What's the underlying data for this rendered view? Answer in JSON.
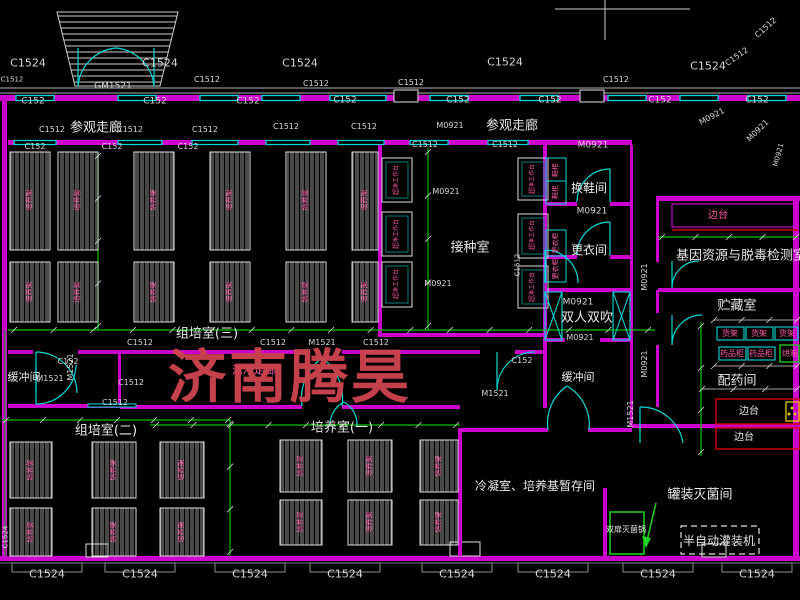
{
  "drawing": {
    "watermark": {
      "text": "济南腾昊",
      "color": "#cf4450"
    },
    "colors": {
      "background": "#000000",
      "wall_magenta": "#cc00cc",
      "window_cyan": "#00d9d9",
      "dimension_green": "#00c000",
      "text_white": "#e4e4e4",
      "equipment_pink": "#fa5aa5",
      "bench_red": "#d90000",
      "sterilizer_green": "#21d421",
      "accent_yellow": "#e6c700"
    },
    "labels": [
      {
        "t": "C1524",
        "x": 28,
        "y": 63,
        "s": 11
      },
      {
        "t": "C1524",
        "x": 160,
        "y": 63,
        "s": 11
      },
      {
        "t": "C1524",
        "x": 300,
        "y": 63,
        "s": 11
      },
      {
        "t": "C1524",
        "x": 505,
        "y": 62,
        "s": 11
      },
      {
        "t": "C1524",
        "x": 708,
        "y": 66,
        "s": 11
      },
      {
        "t": "C1512",
        "x": 737,
        "y": 57,
        "s": 8,
        "r": -35
      },
      {
        "t": "C1512",
        "x": 766,
        "y": 28,
        "s": 8,
        "r": -42
      },
      {
        "t": "GM1521",
        "x": 113,
        "y": 87,
        "s": 9
      },
      {
        "t": "C1512",
        "x": 12,
        "y": 80,
        "s": 7
      },
      {
        "t": "C1512",
        "x": 207,
        "y": 80,
        "s": 8
      },
      {
        "t": "C1512",
        "x": 316,
        "y": 84,
        "s": 8
      },
      {
        "t": "C1512",
        "x": 411,
        "y": 83,
        "s": 8
      },
      {
        "t": "C1512",
        "x": 616,
        "y": 80,
        "s": 8
      },
      {
        "t": "C152",
        "x": 33,
        "y": 102,
        "s": 9
      },
      {
        "t": "C152",
        "x": 155,
        "y": 102,
        "s": 9
      },
      {
        "t": "C152",
        "x": 248,
        "y": 102,
        "s": 9
      },
      {
        "t": "C152",
        "x": 345,
        "y": 101,
        "s": 9
      },
      {
        "t": "C152",
        "x": 458,
        "y": 101,
        "s": 9
      },
      {
        "t": "C152",
        "x": 550,
        "y": 101,
        "s": 9
      },
      {
        "t": "C152",
        "x": 660,
        "y": 101,
        "s": 9
      },
      {
        "t": "C152",
        "x": 757,
        "y": 101,
        "s": 9
      },
      {
        "t": "C1512",
        "x": 52,
        "y": 130,
        "s": 8
      },
      {
        "t": "参观走廊",
        "x": 96,
        "y": 128,
        "s": 13,
        "k": "room"
      },
      {
        "t": "C1512",
        "x": 130,
        "y": 130,
        "s": 8
      },
      {
        "t": "C1512",
        "x": 205,
        "y": 130,
        "s": 8
      },
      {
        "t": "C1512",
        "x": 286,
        "y": 127,
        "s": 8
      },
      {
        "t": "C1512",
        "x": 364,
        "y": 127,
        "s": 8
      },
      {
        "t": "M0921",
        "x": 450,
        "y": 126,
        "s": 8
      },
      {
        "t": "参观走廊",
        "x": 512,
        "y": 126,
        "s": 13,
        "k": "room"
      },
      {
        "t": "M0921",
        "x": 712,
        "y": 117,
        "s": 8,
        "r": -28
      },
      {
        "t": "M0921",
        "x": 758,
        "y": 131,
        "s": 8,
        "r": -45
      },
      {
        "t": "M0921",
        "x": 779,
        "y": 155,
        "s": 7,
        "r": -75
      },
      {
        "t": "C152",
        "x": 35,
        "y": 147,
        "s": 8
      },
      {
        "t": "C152",
        "x": 112,
        "y": 147,
        "s": 8
      },
      {
        "t": "C152",
        "x": 188,
        "y": 147,
        "s": 8
      },
      {
        "t": "C1512",
        "x": 425,
        "y": 145,
        "s": 8
      },
      {
        "t": "C1512",
        "x": 505,
        "y": 145,
        "s": 8
      },
      {
        "t": "M0921",
        "x": 593,
        "y": 146,
        "s": 9
      },
      {
        "t": "换鞋间",
        "x": 589,
        "y": 188,
        "s": 12,
        "k": "room"
      },
      {
        "t": "M0921",
        "x": 592,
        "y": 212,
        "s": 9
      },
      {
        "t": "更衣间",
        "x": 589,
        "y": 250,
        "s": 12,
        "k": "room"
      },
      {
        "t": "M0921",
        "x": 578,
        "y": 303,
        "s": 9
      },
      {
        "t": "双人双吹",
        "x": 587,
        "y": 318,
        "s": 13,
        "k": "room"
      },
      {
        "t": "M0921",
        "x": 580,
        "y": 338,
        "s": 8
      },
      {
        "t": "接种室",
        "x": 470,
        "y": 248,
        "s": 13,
        "k": "room"
      },
      {
        "t": "M0921",
        "x": 446,
        "y": 192,
        "s": 8
      },
      {
        "t": "M0921",
        "x": 438,
        "y": 284,
        "s": 8
      },
      {
        "t": "C1512",
        "x": 518,
        "y": 265,
        "s": 7,
        "r": -90
      },
      {
        "t": "基因资源与脱毒检测室",
        "x": 741,
        "y": 256,
        "s": 13,
        "k": "room"
      },
      {
        "t": "贮藏室",
        "x": 737,
        "y": 306,
        "s": 13,
        "k": "room"
      },
      {
        "t": "边台",
        "x": 718,
        "y": 216,
        "s": 10,
        "k": "equip"
      },
      {
        "t": "M0921",
        "x": 645,
        "y": 277,
        "s": 8,
        "r": -90
      },
      {
        "t": "M0921",
        "x": 645,
        "y": 364,
        "s": 8,
        "r": -90
      },
      {
        "t": "M1521",
        "x": 631,
        "y": 414,
        "s": 8,
        "r": -90
      },
      {
        "t": "货架",
        "x": 730,
        "y": 334,
        "s": 8,
        "k": "equip"
      },
      {
        "t": "货架",
        "x": 759,
        "y": 334,
        "s": 8,
        "k": "equip"
      },
      {
        "t": "货架",
        "x": 787,
        "y": 334,
        "s": 8,
        "k": "equip"
      },
      {
        "t": "药品柜",
        "x": 732,
        "y": 354,
        "s": 8,
        "k": "equip"
      },
      {
        "t": "药品柜",
        "x": 761,
        "y": 354,
        "s": 8,
        "k": "equip"
      },
      {
        "t": "烘箱",
        "x": 790,
        "y": 354,
        "s": 8,
        "k": "equip"
      },
      {
        "t": "配药间",
        "x": 737,
        "y": 381,
        "s": 13,
        "k": "room"
      },
      {
        "t": "边台",
        "x": 749,
        "y": 412,
        "s": 10,
        "k": "room"
      },
      {
        "t": "边台",
        "x": 744,
        "y": 438,
        "s": 10,
        "k": "room"
      },
      {
        "t": "罐装灭菌间",
        "x": 700,
        "y": 495,
        "s": 13,
        "k": "room"
      },
      {
        "t": "双扉灭菌锅",
        "x": 626,
        "y": 530,
        "s": 8,
        "k": "room"
      },
      {
        "t": "半自动灌装机",
        "x": 719,
        "y": 541,
        "s": 12,
        "k": "room"
      },
      {
        "t": "组培室(三)",
        "x": 207,
        "y": 334,
        "s": 13,
        "k": "room"
      },
      {
        "t": "C1512",
        "x": 140,
        "y": 343,
        "s": 8
      },
      {
        "t": "C1512",
        "x": 273,
        "y": 343,
        "s": 8
      },
      {
        "t": "M1521",
        "x": 322,
        "y": 343,
        "s": 8
      },
      {
        "t": "C1512",
        "x": 376,
        "y": 343,
        "s": 8
      },
      {
        "t": "C152",
        "x": 68,
        "y": 362,
        "s": 8
      },
      {
        "t": "C152",
        "x": 522,
        "y": 361,
        "s": 8
      },
      {
        "t": "缓冲间",
        "x": 24,
        "y": 377,
        "s": 11,
        "k": "room"
      },
      {
        "t": "M1521",
        "x": 50,
        "y": 379,
        "s": 8
      },
      {
        "t": "M1521",
        "x": 71,
        "y": 367,
        "s": 8,
        "r": -90
      },
      {
        "t": "洁净走廊",
        "x": 254,
        "y": 370,
        "s": 11,
        "k": "equip"
      },
      {
        "t": "M1521",
        "x": 495,
        "y": 394,
        "s": 8
      },
      {
        "t": "缓冲间",
        "x": 578,
        "y": 377,
        "s": 11,
        "k": "room"
      },
      {
        "t": "C1512",
        "x": 131,
        "y": 383,
        "s": 8
      },
      {
        "t": "C1512",
        "x": 115,
        "y": 403,
        "s": 8
      },
      {
        "t": "组培室(二)",
        "x": 106,
        "y": 431,
        "s": 13,
        "k": "room"
      },
      {
        "t": "培养室(一)",
        "x": 342,
        "y": 428,
        "s": 13,
        "k": "room"
      },
      {
        "t": "冷凝室、培养基暂存间",
        "x": 535,
        "y": 486,
        "s": 12,
        "k": "room"
      },
      {
        "t": "C1524",
        "x": 47,
        "y": 574,
        "s": 11
      },
      {
        "t": "C1524",
        "x": 140,
        "y": 574,
        "s": 11
      },
      {
        "t": "C1524",
        "x": 250,
        "y": 574,
        "s": 11
      },
      {
        "t": "C1524",
        "x": 345,
        "y": 574,
        "s": 11
      },
      {
        "t": "C1524",
        "x": 457,
        "y": 574,
        "s": 11
      },
      {
        "t": "C1524",
        "x": 553,
        "y": 574,
        "s": 11
      },
      {
        "t": "C1524",
        "x": 658,
        "y": 574,
        "s": 11
      },
      {
        "t": "C1524",
        "x": 757,
        "y": 574,
        "s": 11
      },
      {
        "t": "C1524",
        "x": 6,
        "y": 537,
        "s": 7,
        "r": -90
      },
      {
        "t": "培养架",
        "x": 30,
        "y": 200,
        "s": 7,
        "r": -90,
        "k": "equip"
      },
      {
        "t": "培养架",
        "x": 30,
        "y": 292,
        "s": 7,
        "r": -90,
        "k": "equip"
      },
      {
        "t": "培养架",
        "x": 78,
        "y": 200,
        "s": 7,
        "r": -90,
        "k": "equip"
      },
      {
        "t": "培养架",
        "x": 78,
        "y": 292,
        "s": 7,
        "r": -90,
        "k": "equip"
      },
      {
        "t": "培养架",
        "x": 154,
        "y": 200,
        "s": 7,
        "r": -90,
        "k": "equip"
      },
      {
        "t": "培养架",
        "x": 154,
        "y": 292,
        "s": 7,
        "r": -90,
        "k": "equip"
      },
      {
        "t": "培养架",
        "x": 230,
        "y": 200,
        "s": 7,
        "r": -90,
        "k": "equip"
      },
      {
        "t": "培养架",
        "x": 230,
        "y": 292,
        "s": 7,
        "r": -90,
        "k": "equip"
      },
      {
        "t": "培养架",
        "x": 306,
        "y": 200,
        "s": 7,
        "r": -90,
        "k": "equip"
      },
      {
        "t": "培养架",
        "x": 306,
        "y": 292,
        "s": 7,
        "r": -90,
        "k": "equip"
      },
      {
        "t": "培养架",
        "x": 365,
        "y": 200,
        "s": 7,
        "r": -90,
        "k": "equip"
      },
      {
        "t": "培养架",
        "x": 365,
        "y": 292,
        "s": 7,
        "r": -90,
        "k": "equip"
      },
      {
        "t": "培养架",
        "x": 31,
        "y": 470,
        "s": 7,
        "r": -90,
        "k": "equip"
      },
      {
        "t": "培养架",
        "x": 31,
        "y": 532,
        "s": 7,
        "r": -90,
        "k": "equip"
      },
      {
        "t": "培养架",
        "x": 114,
        "y": 470,
        "s": 7,
        "r": -90,
        "k": "equip"
      },
      {
        "t": "培养架",
        "x": 114,
        "y": 532,
        "s": 7,
        "r": -90,
        "k": "equip"
      },
      {
        "t": "培养架",
        "x": 182,
        "y": 470,
        "s": 7,
        "r": -90,
        "k": "equip"
      },
      {
        "t": "培养架",
        "x": 182,
        "y": 532,
        "s": 7,
        "r": -90,
        "k": "equip"
      },
      {
        "t": "培养架",
        "x": 301,
        "y": 466,
        "s": 7,
        "r": -90,
        "k": "equip"
      },
      {
        "t": "培养架",
        "x": 301,
        "y": 522,
        "s": 7,
        "r": -90,
        "k": "equip"
      },
      {
        "t": "培养架",
        "x": 370,
        "y": 466,
        "s": 7,
        "r": -90,
        "k": "equip"
      },
      {
        "t": "培养架",
        "x": 370,
        "y": 522,
        "s": 7,
        "r": -90,
        "k": "equip"
      },
      {
        "t": "培养架",
        "x": 439,
        "y": 466,
        "s": 7,
        "r": -90,
        "k": "equip"
      },
      {
        "t": "培养架",
        "x": 439,
        "y": 522,
        "s": 7,
        "r": -90,
        "k": "equip"
      },
      {
        "t": "超净工作台",
        "x": 397,
        "y": 180,
        "s": 6,
        "r": -90,
        "k": "equip"
      },
      {
        "t": "超净工作台",
        "x": 397,
        "y": 234,
        "s": 6,
        "r": -90,
        "k": "equip"
      },
      {
        "t": "超净工作台",
        "x": 397,
        "y": 284,
        "s": 6,
        "r": -90,
        "k": "equip"
      },
      {
        "t": "超净工作台",
        "x": 533,
        "y": 179,
        "s": 6,
        "r": -90,
        "k": "equip"
      },
      {
        "t": "超净工作台",
        "x": 533,
        "y": 235,
        "s": 6,
        "r": -90,
        "k": "equip"
      },
      {
        "t": "超净工作台",
        "x": 533,
        "y": 287,
        "s": 6,
        "r": -90,
        "k": "equip"
      },
      {
        "t": "鞋柜",
        "x": 556,
        "y": 170,
        "s": 7,
        "r": -90,
        "k": "equip"
      },
      {
        "t": "鞋柜",
        "x": 556,
        "y": 192,
        "s": 7,
        "r": -90,
        "k": "equip"
      },
      {
        "t": "更衣柜",
        "x": 556,
        "y": 243,
        "s": 7,
        "r": -90,
        "k": "equip"
      },
      {
        "t": "更衣柜",
        "x": 556,
        "y": 269,
        "s": 7,
        "r": -90,
        "k": "equip"
      }
    ]
  }
}
